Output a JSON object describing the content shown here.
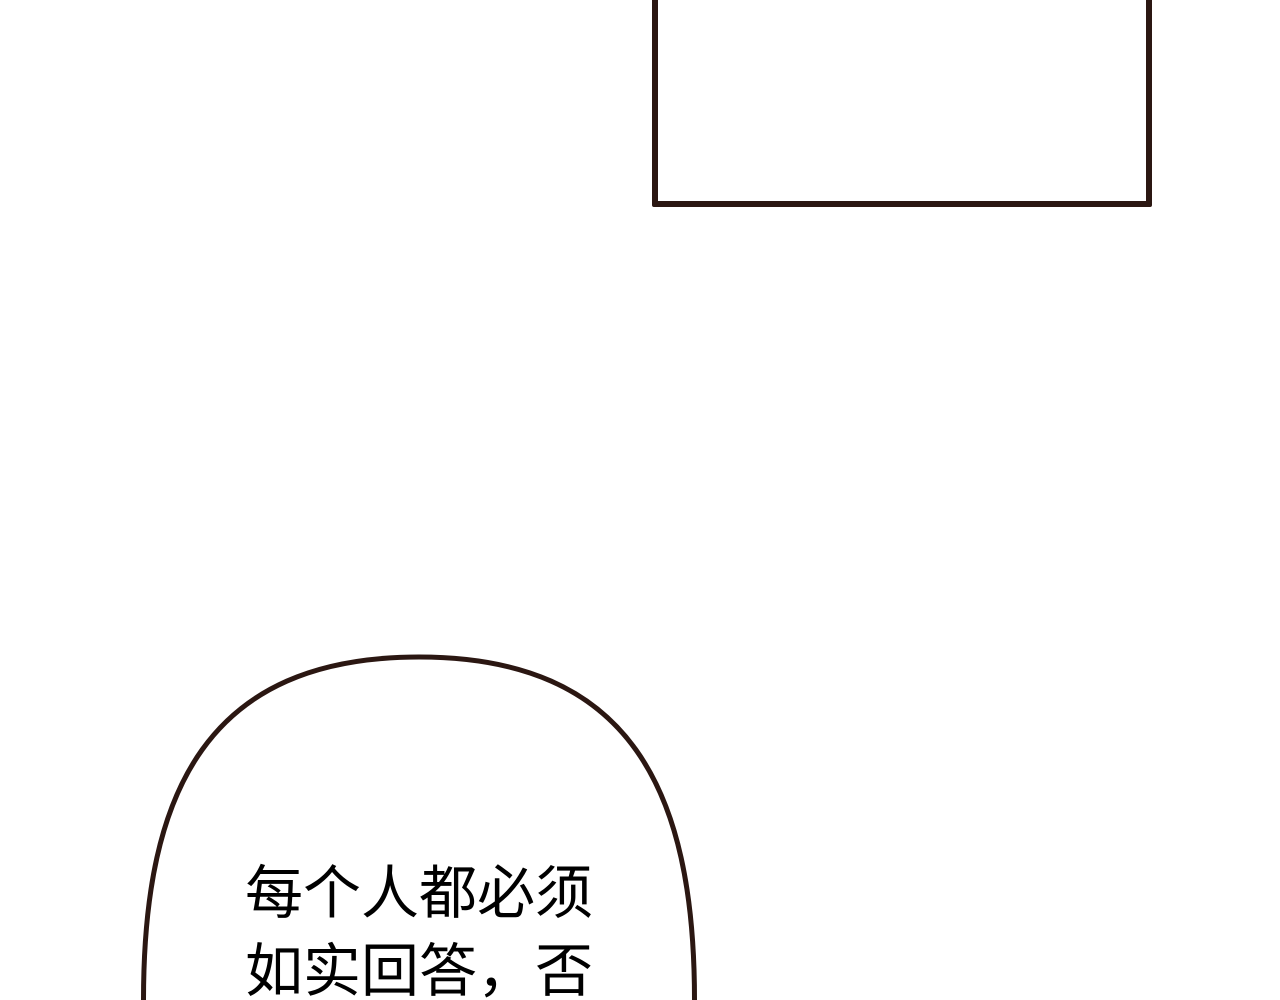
{
  "canvas": {
    "width_px": 1280,
    "height_px": 1000,
    "background_color": "#ffffff"
  },
  "panel_frame": {
    "border_color": "#2b1712",
    "fill_color": "#ffffff"
  },
  "speech_bubble": {
    "outline_color": "#2b1712",
    "fill_color": "#ffffff",
    "text_color": "#000000",
    "lines": [
      "每个人都必须",
      "如实回答，否"
    ]
  }
}
